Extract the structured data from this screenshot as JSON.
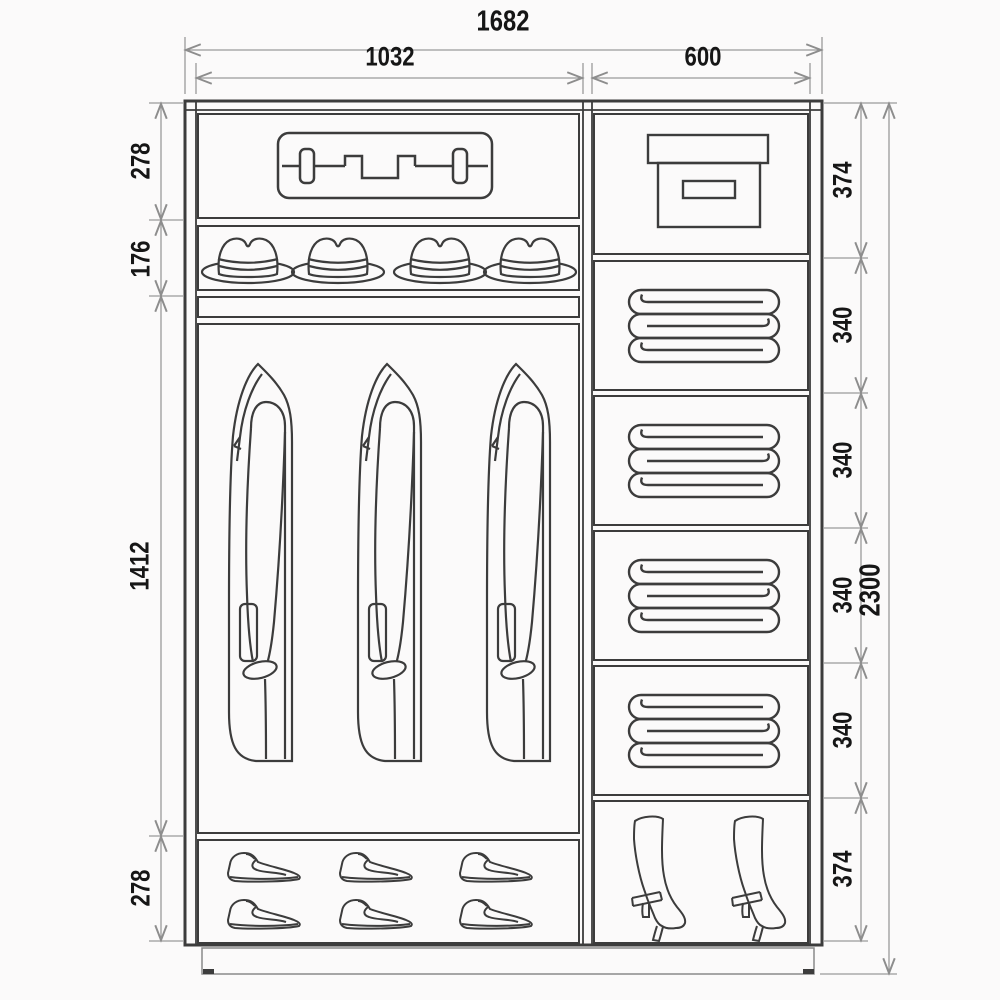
{
  "diagram": {
    "type": "wardrobe-interior-dimension-drawing",
    "units": "mm"
  },
  "dimensions": {
    "total_width": "1682",
    "left_width": "1032",
    "right_width": "600",
    "total_height": "2300",
    "left_sections": [
      "278",
      "176",
      "1412",
      "278"
    ],
    "right_sections": [
      "374",
      "340",
      "340",
      "340",
      "340",
      "374"
    ]
  },
  "compartments": {
    "left": [
      {
        "item": "suitcase-icon",
        "count": 1
      },
      {
        "item": "hat-icon",
        "count": 4
      },
      {
        "item": "coat-icon",
        "count": 3
      },
      {
        "item": "shoe-icon",
        "count": 6
      }
    ],
    "right": [
      {
        "item": "storage-box-icon",
        "count": 1
      },
      {
        "item": "folded-blanket-icon",
        "count": 4
      },
      {
        "item": "boot-icon",
        "count": 2
      }
    ]
  },
  "colors": {
    "structure_line": "#3c3c3c",
    "dimension_line": "#8d8d8d",
    "label_text": "#161616",
    "background": "#fbfafa"
  }
}
